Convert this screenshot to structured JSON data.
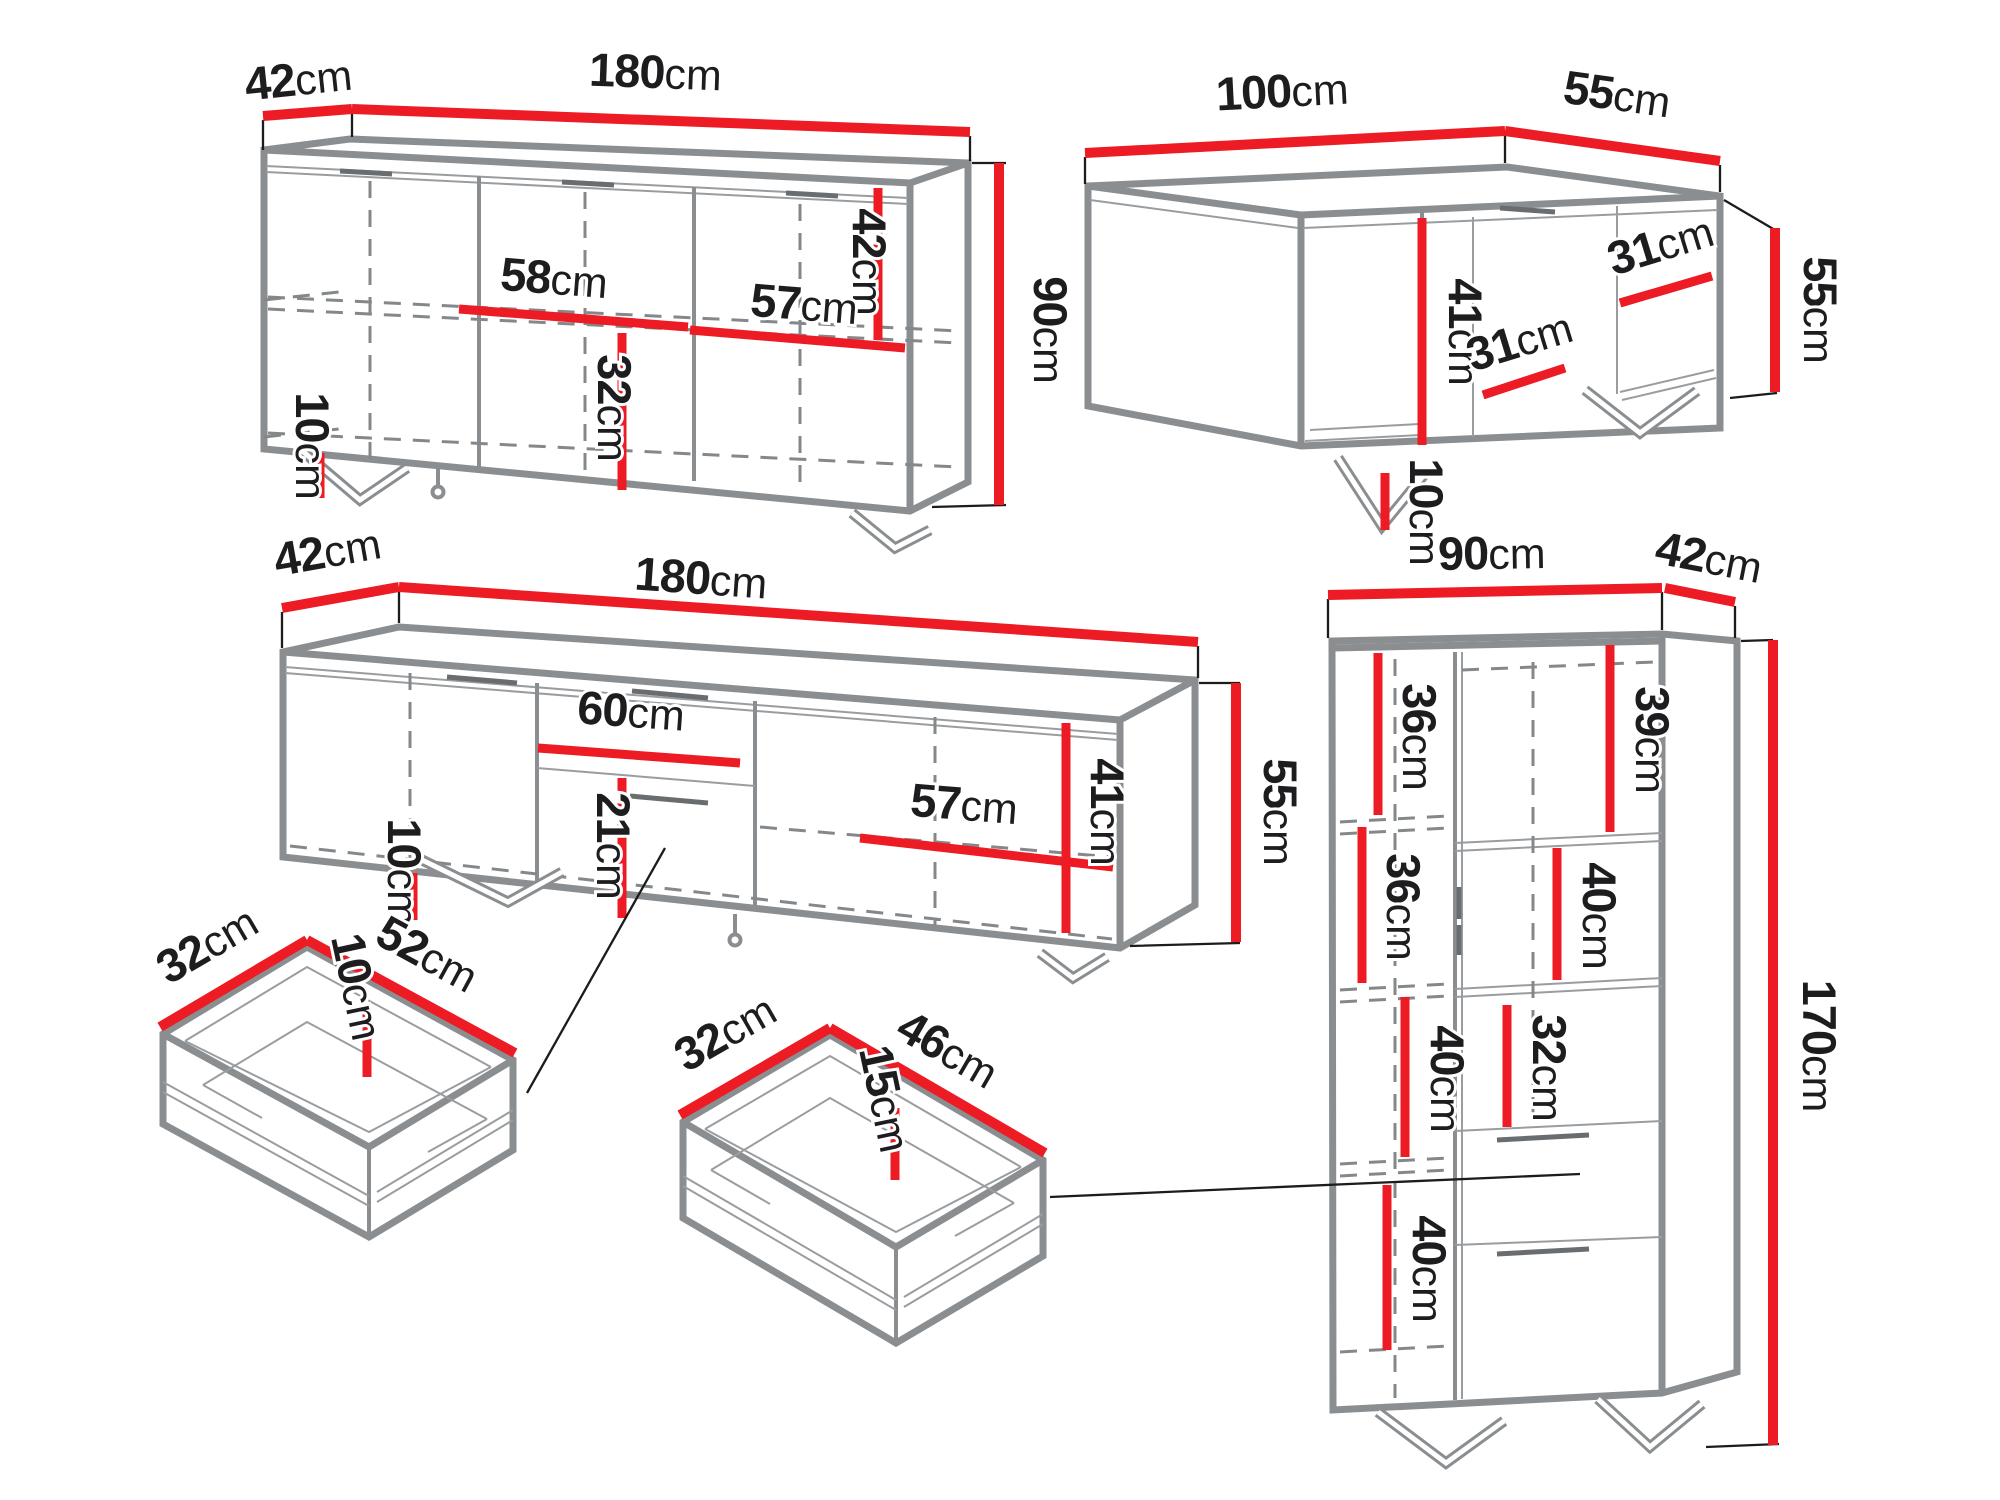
{
  "diagram": {
    "unit": "cm",
    "colors": {
      "dimension_line": "#ec1b24",
      "structure_line": "#8b8e90",
      "hidden_line": "#85888a",
      "text": "#1d1d1f",
      "background": "#ffffff"
    },
    "pieces": {
      "sideboard": {
        "width": "180",
        "depth": "42",
        "height": "90",
        "inner_right_height": "42",
        "middle_shelf_width": "58",
        "right_shelf_width": "57",
        "middle_lower_height": "32",
        "leg_height": "10"
      },
      "coffee_table": {
        "width": "100",
        "depth": "55",
        "height": "55",
        "inner_height": "41",
        "shelf_depth_upper": "31",
        "shelf_depth_lower": "31",
        "leg_height": "10"
      },
      "tv_stand": {
        "depth": "42",
        "width": "180",
        "height": "55",
        "drawer_width": "60",
        "drawer_front_height": "21",
        "right_shelf_width": "57",
        "inner_right_height": "41",
        "leg_height": "10"
      },
      "cabinet": {
        "width": "90",
        "depth": "42",
        "height": "170",
        "left_shelf_1": "36",
        "left_shelf_2": "36",
        "left_shelf_3": "40",
        "left_shelf_4": "40",
        "right_shelf_top": "39",
        "right_shelf_mid": "40",
        "right_shelf_lower": "32"
      },
      "small_drawer": {
        "depth": "32",
        "width": "52",
        "height": "10"
      },
      "large_drawer": {
        "depth": "32",
        "width": "46",
        "height": "15"
      }
    }
  }
}
